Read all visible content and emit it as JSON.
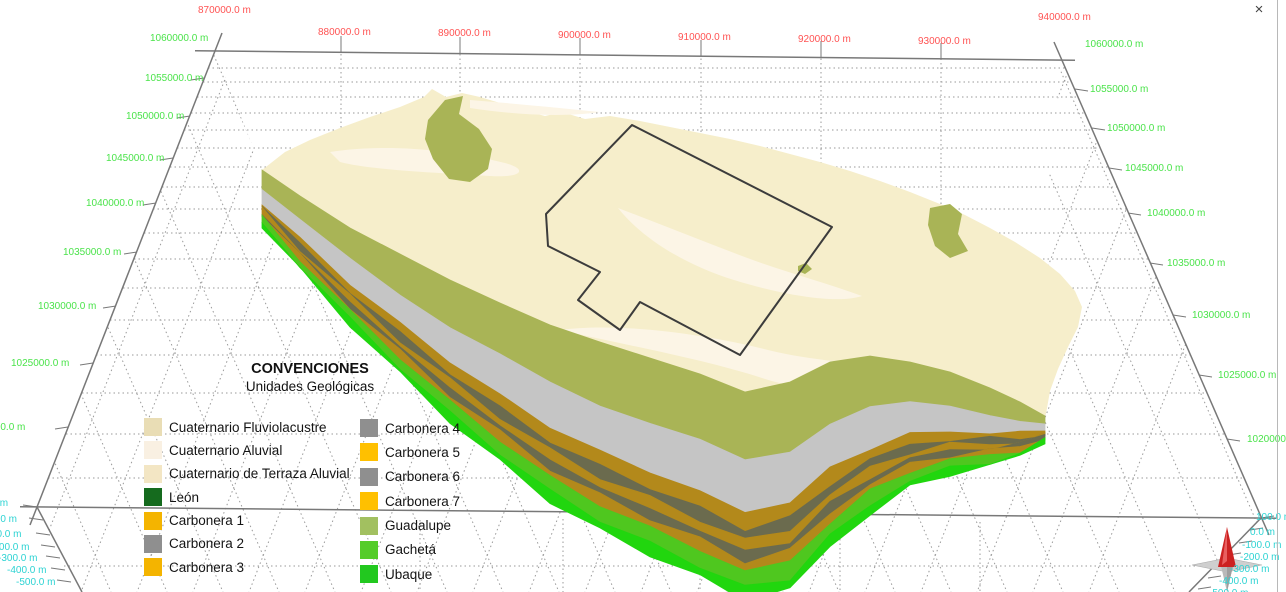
{
  "window": {
    "close_label": "×"
  },
  "axes": {
    "x_top": {
      "color": "#ff5353",
      "labels": [
        "870000.0 m",
        "880000.0 m",
        "890000.0 m",
        "900000.0 m",
        "910000.0 m",
        "920000.0 m",
        "930000.0 m",
        "940000.0 m"
      ]
    },
    "y_left": {
      "color": "#4be34b",
      "labels": [
        "1060000.0 m",
        "1055000.0 m",
        "1050000.0 m",
        "1045000.0 m",
        "1040000.0 m",
        "1035000.0 m",
        "1030000.0 m",
        "1025000.0 m",
        "1020000.0 m"
      ]
    },
    "y_right": {
      "color": "#4be34b",
      "labels": [
        "1060000.0 m",
        "1055000.0 m",
        "1050000.0 m",
        "1045000.0 m",
        "1040000.0 m",
        "1035000.0 m",
        "1030000.0 m",
        "1025000.0 m",
        "1020000.0 m"
      ]
    },
    "z_left": {
      "color": "#2ed3d3",
      "labels": [
        "100.0 m",
        "0.0 m",
        "-100.0 m",
        "-200.0 m",
        "-300.0 m",
        "-400.0 m",
        "-500.0 m"
      ]
    },
    "z_right": {
      "color": "#2ed3d3",
      "labels": [
        "100.0 m",
        "0.0 m",
        "-100.0 m",
        "-200.0 m",
        "-300.0 m",
        "-400.0 m",
        "-500.0 m"
      ]
    }
  },
  "legend": {
    "title": "CONVENCIONES",
    "subtitle": "Unidades Geológicas",
    "items": [
      {
        "label": "Cuaternario Fluviolacustre",
        "color": "#e9ddb5"
      },
      {
        "label": "Cuaternario Aluvial",
        "color": "#f9f0e2"
      },
      {
        "label": "Cuaternario de Terraza Aluvial",
        "color": "#f3e6c4"
      },
      {
        "label": "León",
        "color": "#156b1e"
      },
      {
        "label": "Carbonera 1",
        "color": "#f4b400"
      },
      {
        "label": "Carbonera 2",
        "color": "#8f8f8f"
      },
      {
        "label": "Carbonera 3",
        "color": "#f4b400"
      },
      {
        "label": "Carbonera 4",
        "color": "#8f8f8f"
      },
      {
        "label": "Carbonera 5",
        "color": "#ffc000"
      },
      {
        "label": "Carbonera 6",
        "color": "#8f8f8f"
      },
      {
        "label": "Carbonera 7",
        "color": "#ffc000"
      },
      {
        "label": "Guadalupe",
        "color": "#a2c060"
      },
      {
        "label": "Gachetá",
        "color": "#54cc29"
      },
      {
        "label": "Ubaque",
        "color": "#22c81f"
      }
    ]
  },
  "model": {
    "colors": {
      "surface": "#f6eecb",
      "alluvial": "#fcf5e6",
      "guadalupe": "#a9b456",
      "gray": "#c5c5c5",
      "mustard": "#b3891b",
      "dark": "#6b6b4e",
      "gacheta": "#4fc71f",
      "ubaque": "#21d60e",
      "outline": "#3c3c3c"
    }
  },
  "compass": {
    "needle_color": "#cc2222"
  }
}
